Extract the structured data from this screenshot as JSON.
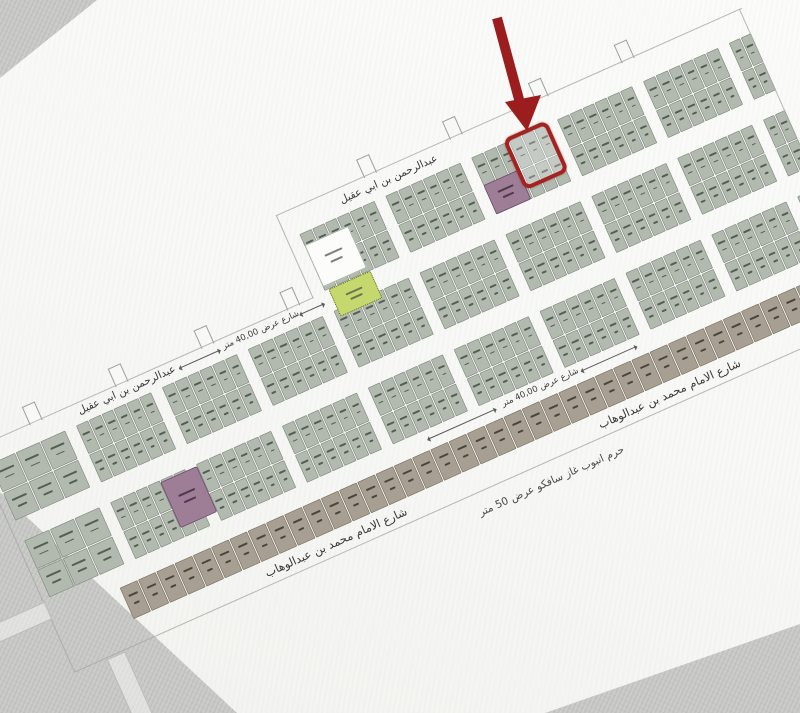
{
  "scene": {
    "description": "photograph of a land subdivision plot map with one parcel highlighted by a red outline and arrow"
  },
  "labels": {
    "street_top_name": "عبدالرحمن بن ابي عقيل",
    "street_bottom_name": "شارع الامام محمد بن عبدالوهاب",
    "street_width_40": "شارع عرض 40,00 متر",
    "pipeline_easement": "حرم انبوب غاز سافكو عرض 50 متر"
  },
  "colors": {
    "residential_plot": "#b2bab0",
    "commercial_plot": "#a89f93",
    "mosque_plot": "#9d7e96",
    "garden_plot": "#c5d86e",
    "school_plot": "#fcfcfa",
    "highlight_red": "#a32222",
    "arrow_red": "#9b1d1d",
    "paper": "#f8f8f6",
    "background": "#c9c9c7"
  },
  "plan": {
    "band_w": 900,
    "rows": [
      {
        "id": "A",
        "y": 44,
        "h": 62,
        "block_w": 82,
        "plots": 6,
        "big_first": false,
        "block_xs": [
          404,
          498,
          592,
          686,
          780,
          874
        ]
      },
      {
        "id": "B",
        "y": 128,
        "h": 62,
        "block_w": 82,
        "plots": 6,
        "big_first": true,
        "block_xs": [
          28,
          122,
          216,
          310,
          404,
          498,
          592,
          686,
          780,
          874
        ]
      },
      {
        "id": "C",
        "y": 212,
        "h": 62,
        "block_w": 82,
        "plots": 6,
        "big_first": true,
        "block_xs": [
          28,
          122,
          216,
          310,
          404,
          498,
          592,
          686,
          780,
          874
        ]
      }
    ],
    "commercial": {
      "y": 294,
      "h": 34,
      "x0": 96,
      "count": 40,
      "plot_w": 19
    },
    "stubs_top": [
      486,
      580,
      674,
      768
    ],
    "stubs_left": [
      80,
      174,
      268,
      362
    ]
  }
}
